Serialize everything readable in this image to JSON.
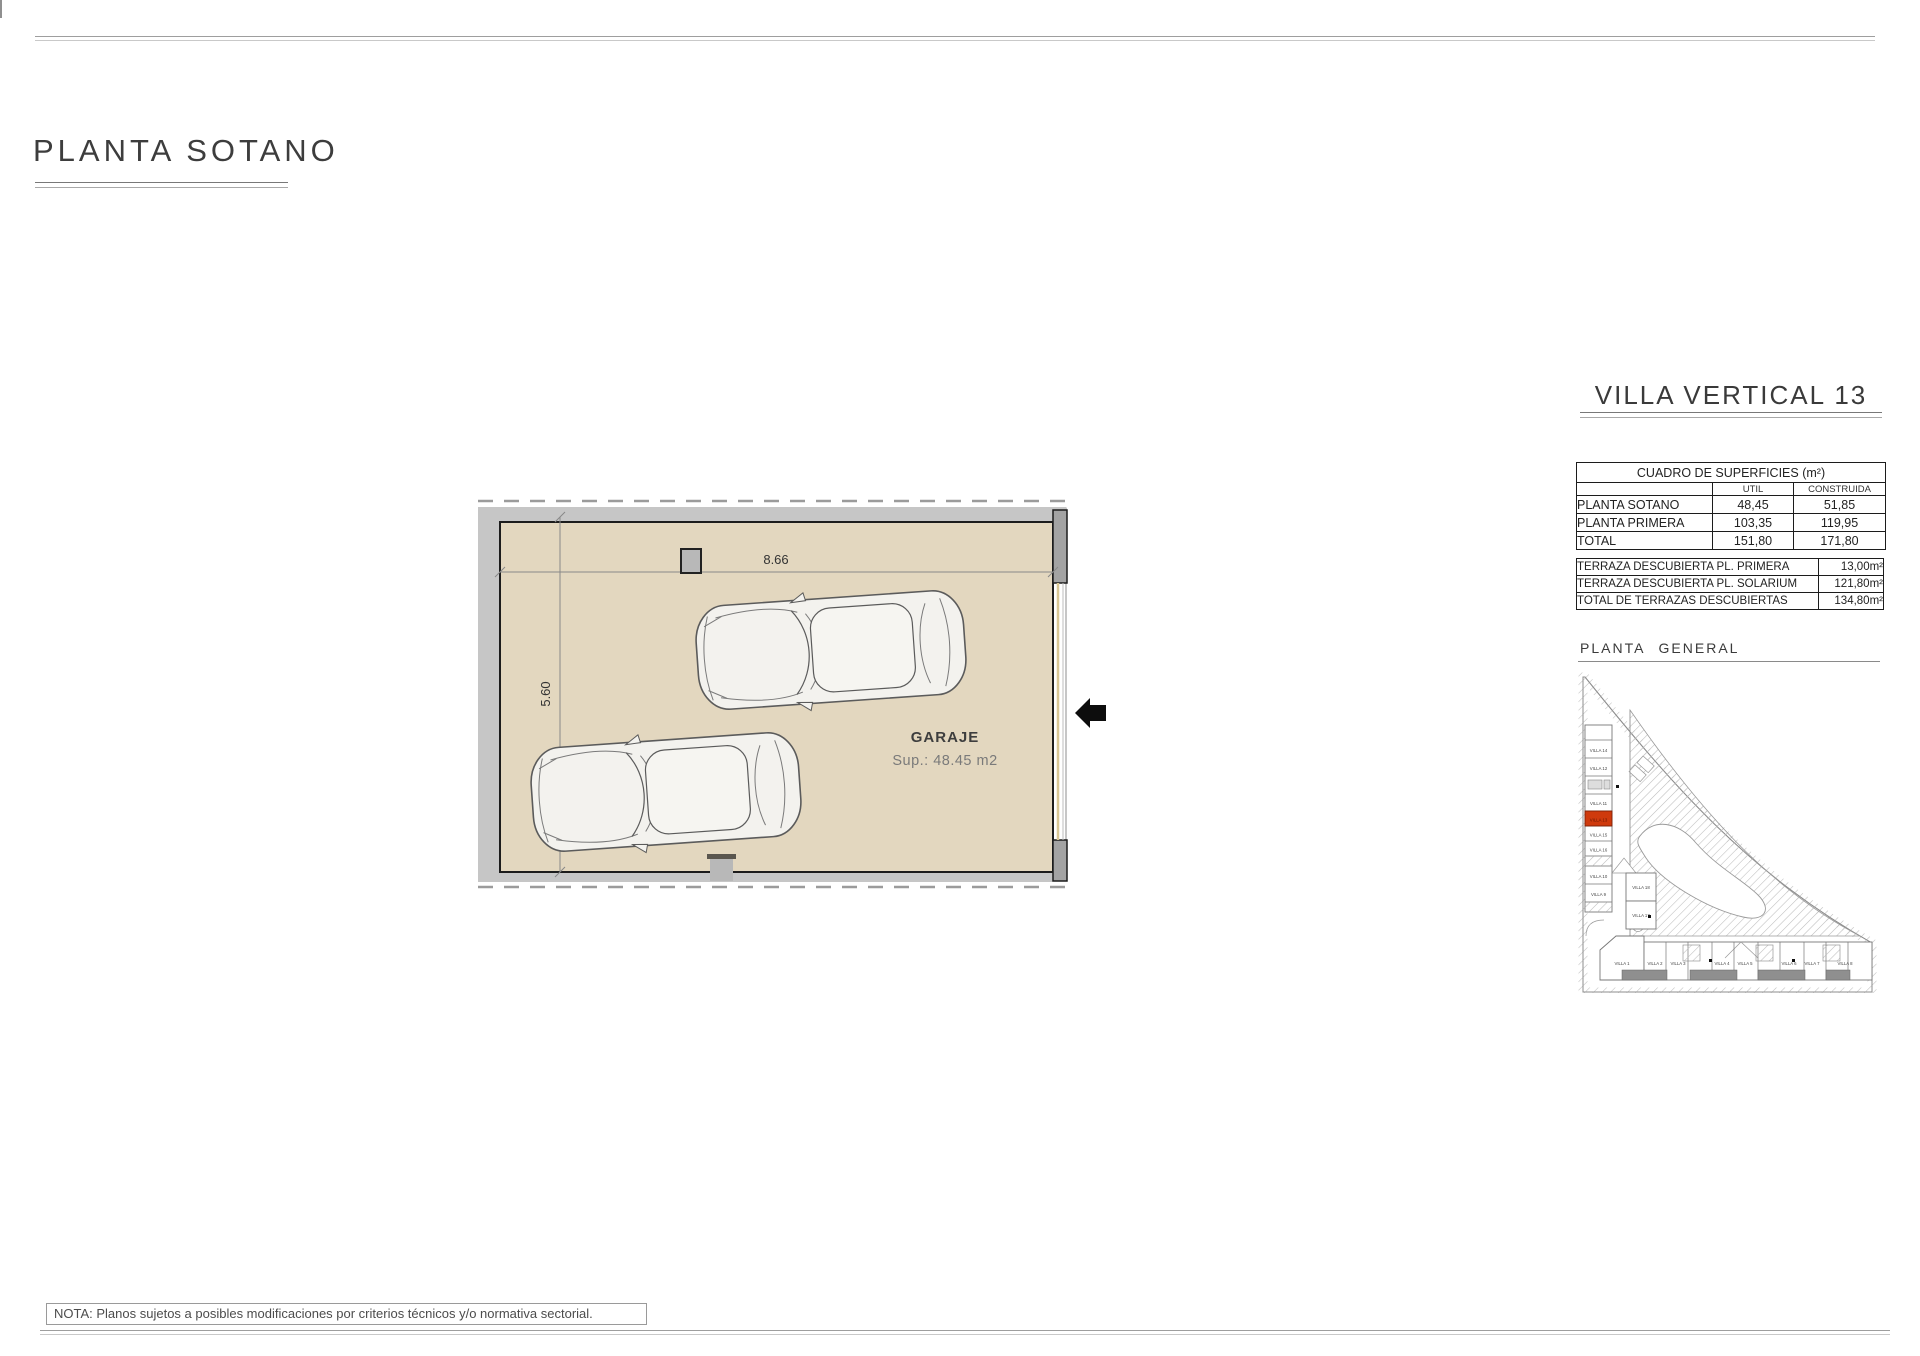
{
  "page": {
    "title": "PLANTA SOTANO",
    "note": "NOTA: Planos sujetos a posibles modificaciones por criterios técnicos y/o normativa sectorial."
  },
  "garage_plan": {
    "room_label": "GARAJE",
    "room_area": "Sup.: 48.45 m2",
    "dim_width": "8.66",
    "dim_height": "5.60",
    "floor_color": "#e3d7bf"
  },
  "right_panel": {
    "title": "VILLA VERTICAL 13",
    "surfaces_table": {
      "title": "CUADRO DE SUPERFICIES (m²)",
      "col_headers": [
        "UTIL",
        "CONSTRUIDA"
      ],
      "rows": [
        {
          "label": "PLANTA SOTANO",
          "util": "48,45",
          "construida": "51,85"
        },
        {
          "label": "PLANTA PRIMERA",
          "util": "103,35",
          "construida": "119,95"
        },
        {
          "label": "TOTAL",
          "util": "151,80",
          "construida": "171,80"
        }
      ]
    },
    "terraces_table": {
      "rows": [
        {
          "label": "TERRAZA DESCUBIERTA PL. PRIMERA",
          "value": "13,00m²"
        },
        {
          "label": "TERRAZA DESCUBIERTA PL. SOLARIUM",
          "value": "121,80m²"
        },
        {
          "label": "TOTAL DE TERRAZAS DESCUBIERTAS",
          "value": "134,80m²"
        }
      ]
    },
    "site_plan": {
      "title": "PLANTA GENERAL",
      "highlighted_unit": "VILLA 13",
      "highlight_color": "#cf3a0d",
      "left_column": [
        "VILLA 14",
        "VILLA 12",
        "VILLA 11",
        "VILLA 13",
        "VILLA 15",
        "VILLA 16",
        "VILLA 10",
        "VILLA 9"
      ],
      "center_column": [
        "VILLA 18",
        "VILLA 17"
      ],
      "bottom_row": [
        "VILLA 1",
        "VILLA 2",
        "VILLA 3",
        "VILLA 4",
        "VILLA 5",
        "VILLA 6",
        "VILLA 7",
        "VILLA 8"
      ]
    }
  }
}
